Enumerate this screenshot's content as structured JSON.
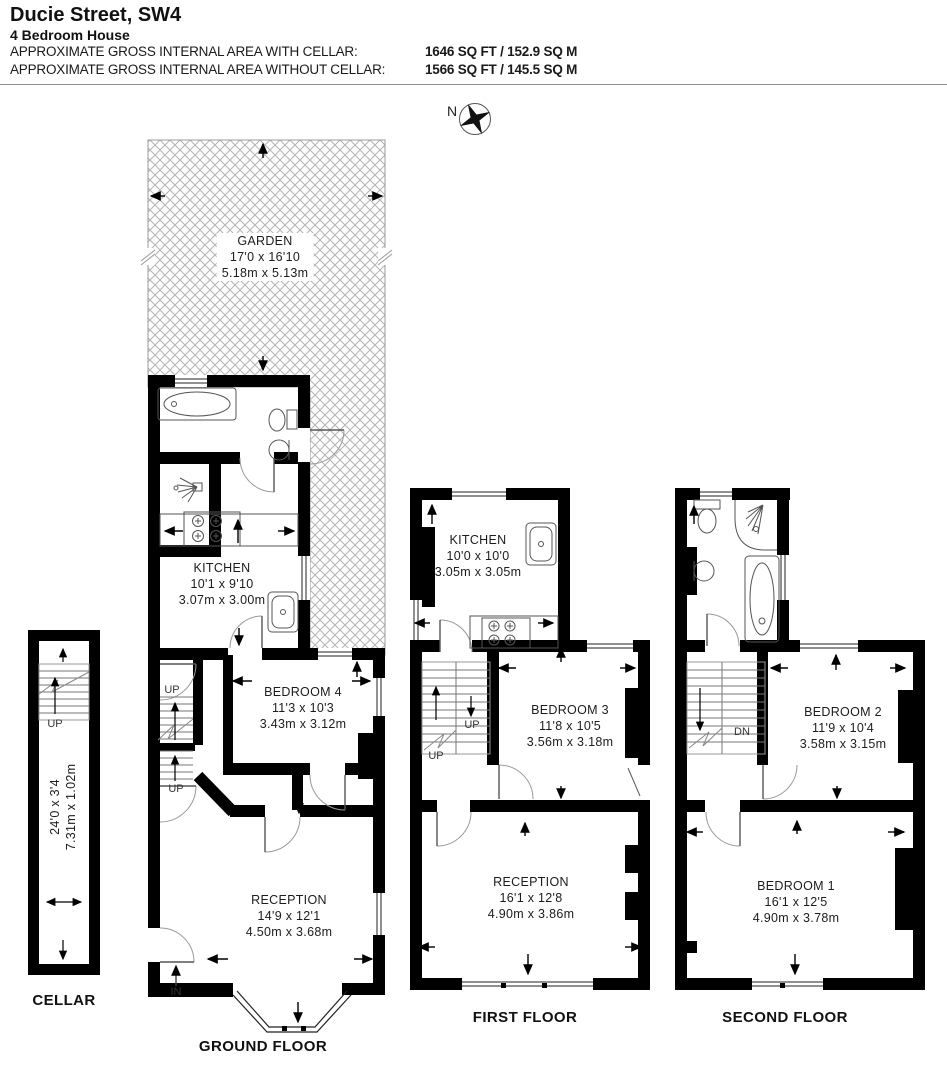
{
  "header": {
    "title": "Ducie Street, SW4",
    "subtitle": "4 Bedroom House",
    "area_lines": [
      {
        "label": "APPROXIMATE GROSS INTERNAL AREA WITH CELLAR:",
        "value": "1646 SQ FT / 152.9 SQ M"
      },
      {
        "label": "APPROXIMATE GROSS INTERNAL AREA WITHOUT CELLAR:",
        "value": "1566 SQ FT / 145.5 SQ M"
      }
    ]
  },
  "compass": {
    "north": "N"
  },
  "garden": {
    "name": "GARDEN",
    "imperial": "17'0 x 16'10",
    "metric": "5.18m x 5.13m"
  },
  "floors": {
    "ground": {
      "label": "GROUND FLOOR",
      "rooms": {
        "kitchen": {
          "name": "KITCHEN",
          "imperial": "10'1 x 9'10",
          "metric": "3.07m x 3.00m"
        },
        "bedroom4": {
          "name": "BEDROOM 4",
          "imperial": "11'3 x 10'3",
          "metric": "3.43m x 3.12m"
        },
        "reception": {
          "name": "RECEPTION",
          "imperial": "14'9 x 12'1",
          "metric": "4.50m x 3.68m"
        }
      }
    },
    "first": {
      "label": "FIRST FLOOR",
      "rooms": {
        "kitchen": {
          "name": "KITCHEN",
          "imperial": "10'0 x 10'0",
          "metric": "3.05m x 3.05m"
        },
        "bedroom3": {
          "name": "BEDROOM 3",
          "imperial": "11'8 x 10'5",
          "metric": "3.56m x 3.18m"
        },
        "reception": {
          "name": "RECEPTION",
          "imperial": "16'1 x 12'8",
          "metric": "4.90m x 3.86m"
        }
      }
    },
    "second": {
      "label": "SECOND FLOOR",
      "rooms": {
        "bedroom2": {
          "name": "BEDROOM 2",
          "imperial": "11'9 x 10'4",
          "metric": "3.58m x 3.15m"
        },
        "bedroom1": {
          "name": "BEDROOM 1",
          "imperial": "16'1 x 12'5",
          "metric": "4.90m x 3.78m"
        }
      }
    },
    "cellar": {
      "label": "CELLAR",
      "dims": {
        "imperial": "24'0 x 3'4",
        "metric": "7.31m x 1.02m"
      }
    }
  },
  "annotations": {
    "up": "UP",
    "down": "DN",
    "entrance": "IN"
  },
  "colors": {
    "wall": "#000000",
    "hatch": "#b3b3b3",
    "background": "#ffffff"
  }
}
